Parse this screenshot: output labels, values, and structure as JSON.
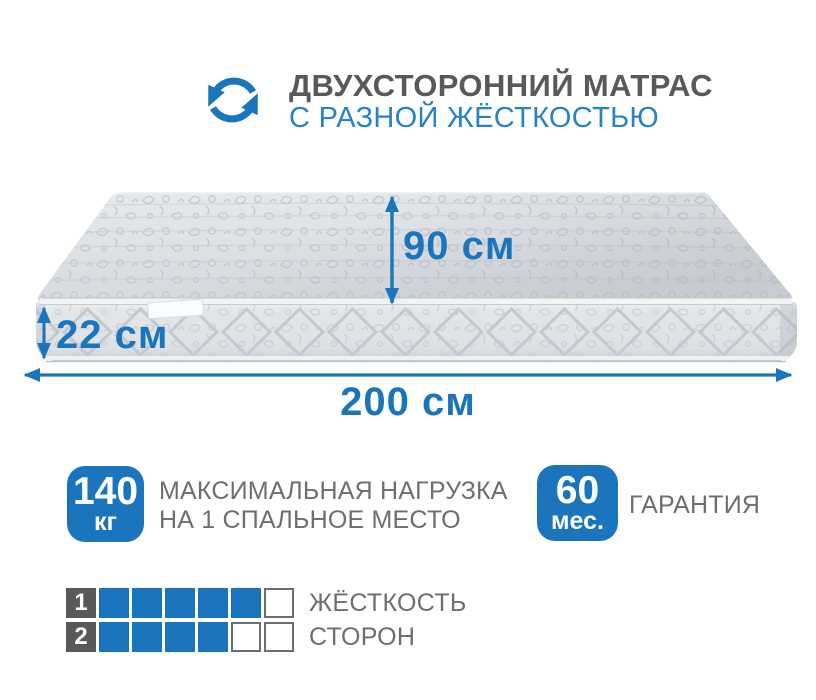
{
  "header": {
    "icon": "flip-arrows",
    "title": "ДВУХСТОРОННИЙ МАТРАС",
    "subtitle": "С РАЗНОЙ ЖЁСТКОСТЬЮ"
  },
  "dimensions": {
    "depth_label": "90 см",
    "height_label": "22 см",
    "width_label": "200 см"
  },
  "badges": {
    "max_load": {
      "value": "140",
      "unit": "кг",
      "line1": "МАКСИМАЛЬНАЯ НАГРУЗКА",
      "line2": "НА 1 СПАЛЬНОЕ МЕСТО"
    },
    "warranty": {
      "value": "60",
      "unit": "мес.",
      "label": "ГАРАНТИЯ"
    }
  },
  "firmness": {
    "rows": [
      {
        "num": "1",
        "filled": 5,
        "total": 6,
        "label": "ЖЁСТКОСТЬ"
      },
      {
        "num": "2",
        "filled": 4,
        "total": 6,
        "label": "СТОРОН"
      }
    ]
  },
  "colors": {
    "accent": "#1b75bc",
    "subtitle_blue": "#2583ca",
    "title_gray": "#58595b",
    "text_gray": "#6d6e71"
  }
}
